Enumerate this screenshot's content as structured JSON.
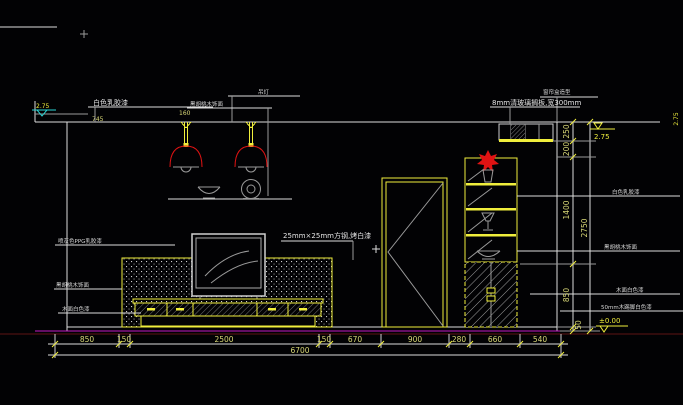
{
  "labels": {
    "ceiling_paint_left": "白色乳胶漆",
    "pendant": "吊灯",
    "walnut_top": "黑胡桃木饰面",
    "ppg": "喷灰色PPG乳胶漆",
    "walnut_left": "黑胡桃木饰面",
    "wood_white_left": "木面白色漆",
    "steel": "25mm×25mm方钢,烤白漆",
    "curtain_box": "窗帘盒造型",
    "glass_shelf": "8mm清玻璃搁板,宽300mm",
    "ceiling_paint_right": "白色乳胶漆",
    "walnut_right": "黑胡桃木饰面",
    "wood_white_right": "木面白色漆",
    "skirting": "50mm木踢脚白色漆"
  },
  "dims": {
    "bottom": [
      "850",
      "150",
      "2500",
      "150",
      "670",
      "900",
      "280",
      "660",
      "540"
    ],
    "total": "6700",
    "right": [
      "250",
      "200",
      "1400",
      "850",
      "50"
    ],
    "right_total": "2750",
    "ceiling_a": "745",
    "ceiling_b": "160"
  },
  "elev": {
    "top": "2.75",
    "bottom": "±0.00",
    "left": "2.75",
    "right_edge": "2.75"
  },
  "colors": {
    "background": "#020204",
    "line_white": "#dcdcdc",
    "line_yellow": "#f0ee3c",
    "lamp_red": "#e01313",
    "floor_magenta": "#c41ac4",
    "dim_text": "#d9d877",
    "marker_cyan": "#2ad4d4"
  }
}
